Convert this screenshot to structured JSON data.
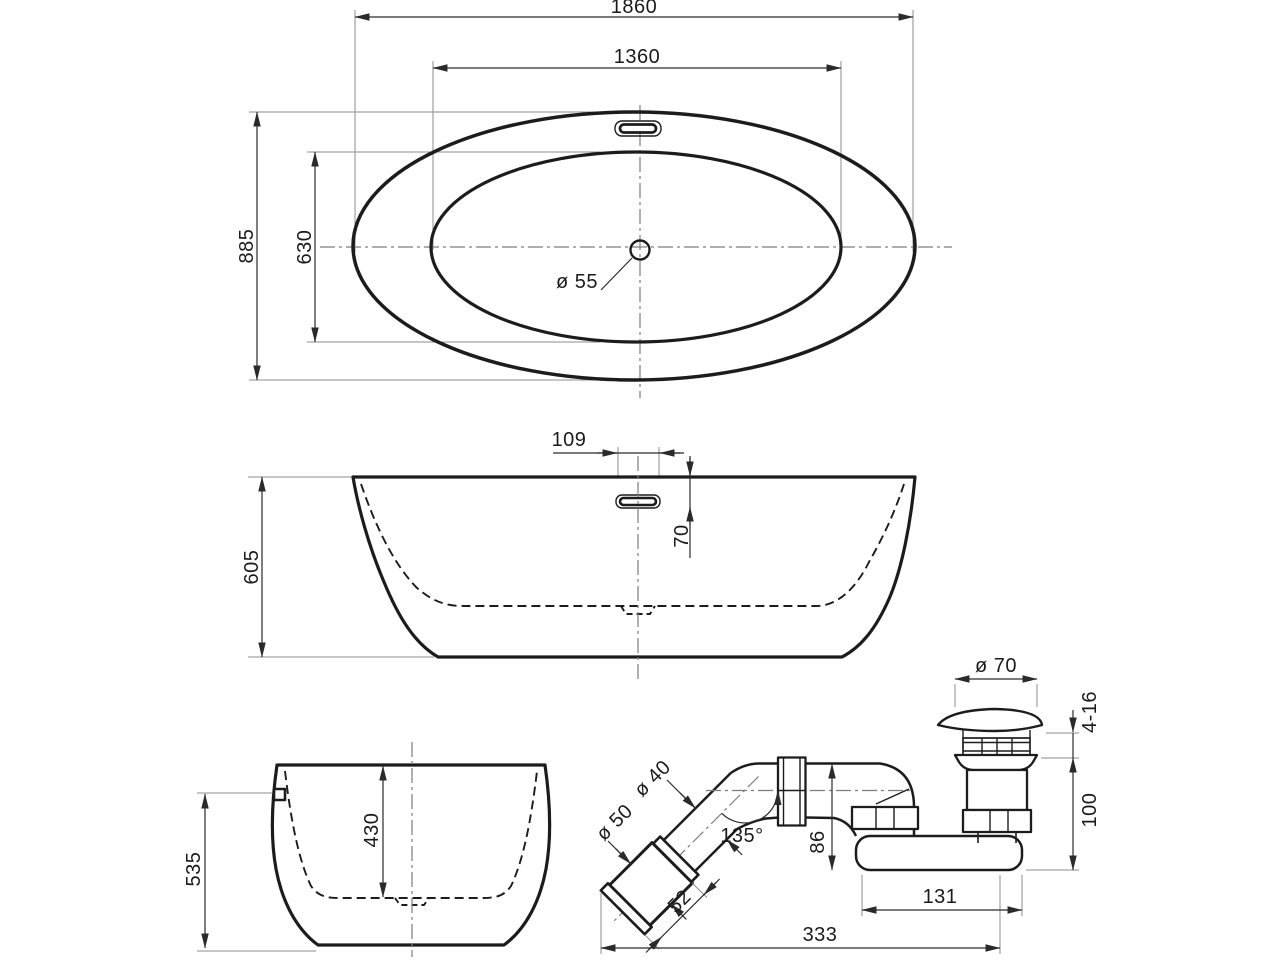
{
  "title": "bathtub-technical-drawing",
  "colors": {
    "line": "#1c1c1c",
    "dimension": "#2a2a2a",
    "extension": "#8c8c8c",
    "background": "#ffffff"
  },
  "dims": {
    "top": {
      "overall_length": "1860",
      "inner_length": "1360",
      "overall_width": "885",
      "inner_width": "630",
      "drain_diameter": "ø 55"
    },
    "side": {
      "height": "605",
      "overflow_width": "109",
      "overflow_drop": "70"
    },
    "end": {
      "overflow_height": "535",
      "inner_depth": "430"
    },
    "waste": {
      "cap_diameter": "ø 70",
      "adjust_range": "4-16",
      "drain_height": "100",
      "outlet_length": "131",
      "total_length": "333",
      "elbow_height": "86",
      "elbow_angle": "135°",
      "pipe_diameter": "ø 40",
      "cuff_diameter": "ø 50",
      "cuff_length": "52"
    }
  }
}
